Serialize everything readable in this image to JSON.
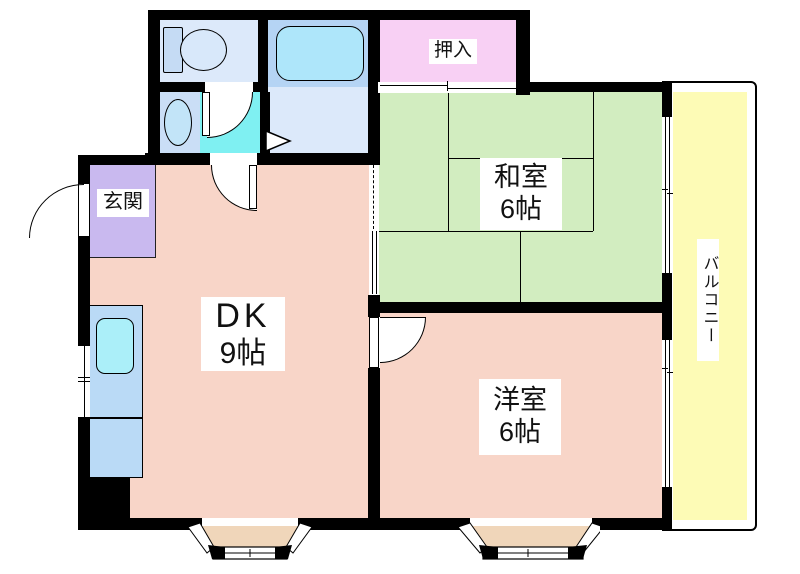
{
  "floorplan": {
    "type": "apartment-floor-plan",
    "rooms": {
      "genkan": {
        "name": "玄関"
      },
      "oshiire": {
        "name": "押入"
      },
      "washitsu": {
        "name": "和室",
        "size": "6帖"
      },
      "dk": {
        "name": "DK",
        "size": "9帖"
      },
      "youshitsu": {
        "name": "洋室",
        "size": "6帖"
      },
      "balcony": {
        "name": "バルコニー"
      }
    },
    "colors": {
      "wall": "#000000",
      "room_salmon": "#f8d5c8",
      "tatami_green": "#d2edc0",
      "closet_pink": "#f8d0f4",
      "entry_purple": "#c9b9ef",
      "balcony_yellow": "#fdfbb6",
      "washroom_cyan": "#7ff0f2",
      "bath_blue": "#b5d4f4",
      "sanitary_blue_light": "#dce9fa",
      "washbasin_blue": "#cadef6",
      "counter_blue": "#badaf6",
      "fixture_cyan": "#abeff9",
      "bay_window_tan": "#f0d6ba"
    }
  }
}
